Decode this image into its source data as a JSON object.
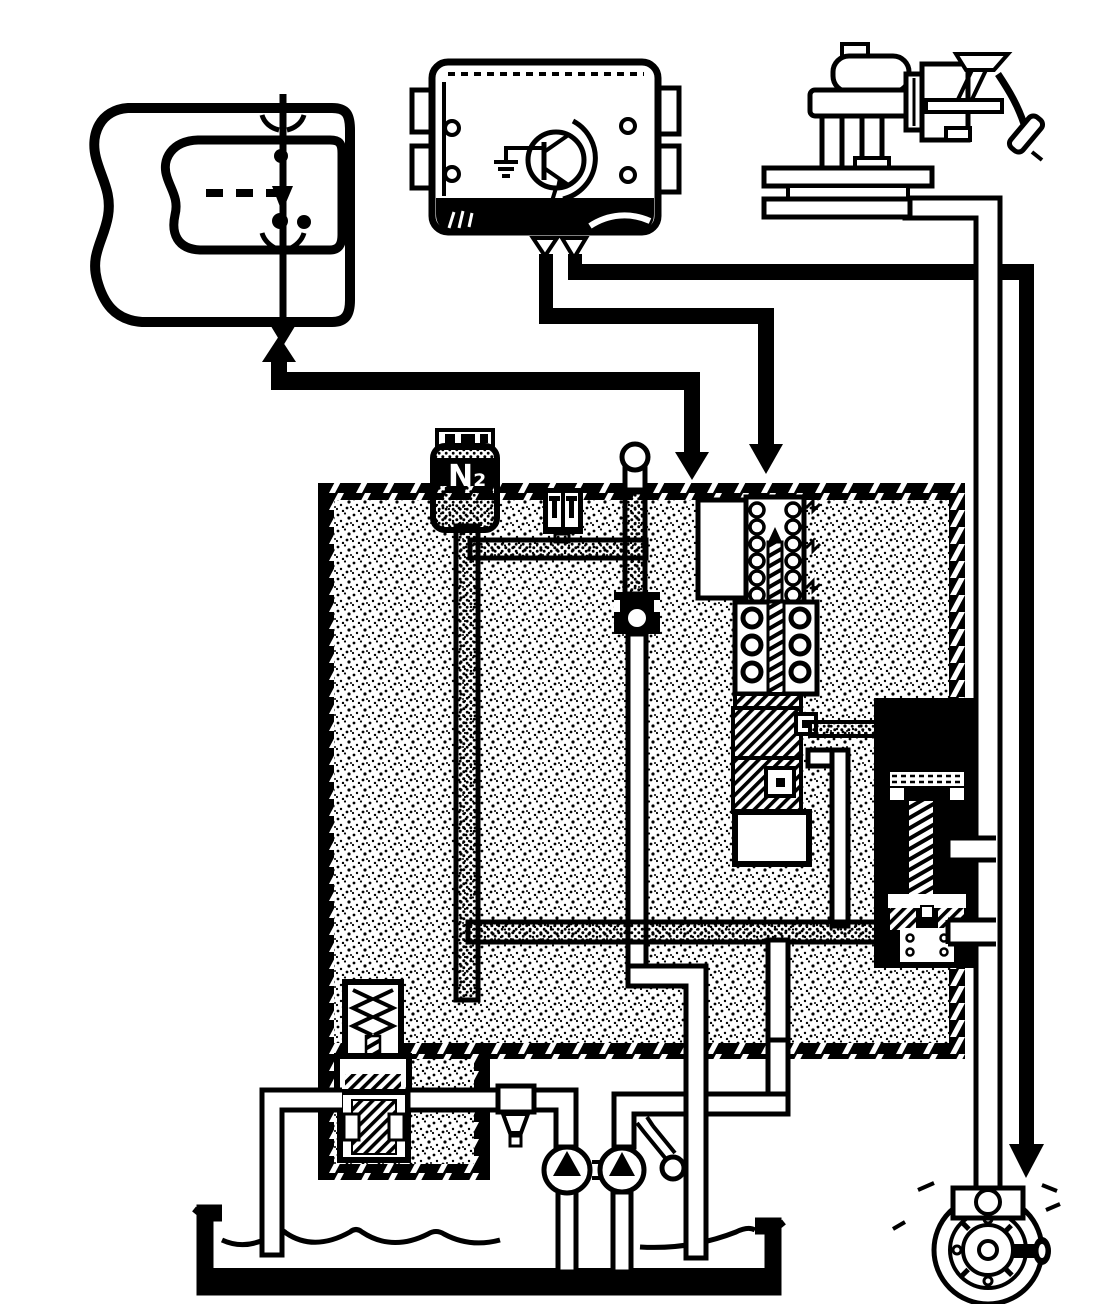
{
  "meta": {
    "diagram_kind": "automatic-transmission hydraulic and electronic control schematic",
    "palette": {
      "ink": "#000000",
      "paper": "#ffffff"
    }
  },
  "accumulator": {
    "label": "N₂"
  },
  "components": {
    "selector_panel": "gear-selector-panel-with-lever",
    "control_unit": "electronic-control-unit",
    "throttle": "carburetor-with-accelerator-pedal",
    "hydraulic_box": "stippled-transmission-hydraulic-unit",
    "accumulator": "nitrogen-accumulator",
    "solenoid": "shift-solenoid-valve",
    "spool_valve": "shift-spool-valve",
    "servo": "servo-piston-actuator",
    "regulator": "pressure-regulator-valve",
    "pumps": "twin-hydraulic-pumps",
    "reservoir": "oil-sump-pan",
    "governor": "output-shaft-governor-wheel"
  }
}
